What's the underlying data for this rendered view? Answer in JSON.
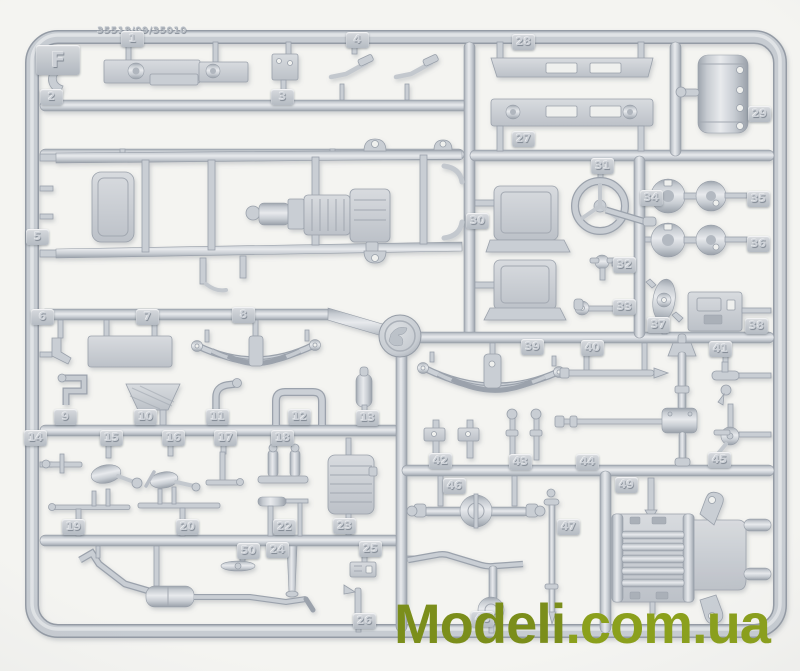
{
  "sprue": {
    "letter": "F",
    "mold_text": "35518/09/35010"
  },
  "watermark": {
    "text_primary": "Modeli",
    "text_secondary": ".com.ua"
  },
  "colors": {
    "background": "#f4f4f1",
    "plastic": "#c9ced4",
    "plastic_shadow": "#99a0a9",
    "plastic_highlight": "#e8eaed",
    "watermark_primary": "#7b8e1b",
    "watermark_secondary": "#8ba01c"
  },
  "part_tags": [
    {
      "num": "1",
      "x": 121,
      "y": 31
    },
    {
      "num": "2",
      "x": 40,
      "y": 89
    },
    {
      "num": "3",
      "x": 271,
      "y": 89
    },
    {
      "num": "4",
      "x": 346,
      "y": 32
    },
    {
      "num": "5",
      "x": 26,
      "y": 229
    },
    {
      "num": "6",
      "x": 31,
      "y": 309
    },
    {
      "num": "7",
      "x": 136,
      "y": 309
    },
    {
      "num": "8",
      "x": 232,
      "y": 307
    },
    {
      "num": "9",
      "x": 54,
      "y": 409
    },
    {
      "num": "10",
      "x": 134,
      "y": 409
    },
    {
      "num": "11",
      "x": 206,
      "y": 409
    },
    {
      "num": "12",
      "x": 288,
      "y": 409
    },
    {
      "num": "13",
      "x": 356,
      "y": 410
    },
    {
      "num": "14",
      "x": 24,
      "y": 430
    },
    {
      "num": "15",
      "x": 100,
      "y": 430
    },
    {
      "num": "16",
      "x": 162,
      "y": 430
    },
    {
      "num": "17",
      "x": 214,
      "y": 430
    },
    {
      "num": "18",
      "x": 271,
      "y": 430
    },
    {
      "num": "19",
      "x": 62,
      "y": 519
    },
    {
      "num": "20",
      "x": 176,
      "y": 519
    },
    {
      "num": "22",
      "x": 273,
      "y": 519
    },
    {
      "num": "23",
      "x": 333,
      "y": 518
    },
    {
      "num": "50",
      "x": 237,
      "y": 543
    },
    {
      "num": "24",
      "x": 266,
      "y": 542
    },
    {
      "num": "25",
      "x": 359,
      "y": 541
    },
    {
      "num": "26",
      "x": 353,
      "y": 613
    },
    {
      "num": "27",
      "x": 512,
      "y": 131
    },
    {
      "num": "28",
      "x": 512,
      "y": 34
    },
    {
      "num": "29",
      "x": 748,
      "y": 106
    },
    {
      "num": "30",
      "x": 466,
      "y": 213
    },
    {
      "num": "31",
      "x": 591,
      "y": 158
    },
    {
      "num": "32",
      "x": 613,
      "y": 257
    },
    {
      "num": "33",
      "x": 613,
      "y": 299
    },
    {
      "num": "34",
      "x": 640,
      "y": 190
    },
    {
      "num": "35",
      "x": 747,
      "y": 191
    },
    {
      "num": "36",
      "x": 747,
      "y": 236
    },
    {
      "num": "37",
      "x": 647,
      "y": 317
    },
    {
      "num": "38",
      "x": 745,
      "y": 318
    },
    {
      "num": "39",
      "x": 521,
      "y": 339
    },
    {
      "num": "40",
      "x": 581,
      "y": 340
    },
    {
      "num": "41",
      "x": 709,
      "y": 341
    },
    {
      "num": "42",
      "x": 429,
      "y": 453
    },
    {
      "num": "43",
      "x": 509,
      "y": 454
    },
    {
      "num": "44",
      "x": 576,
      "y": 454
    },
    {
      "num": "45",
      "x": 708,
      "y": 452
    },
    {
      "num": "46",
      "x": 443,
      "y": 478
    },
    {
      "num": "47",
      "x": 557,
      "y": 519
    },
    {
      "num": "48",
      "x": 471,
      "y": 611
    },
    {
      "num": "49",
      "x": 615,
      "y": 477
    }
  ]
}
